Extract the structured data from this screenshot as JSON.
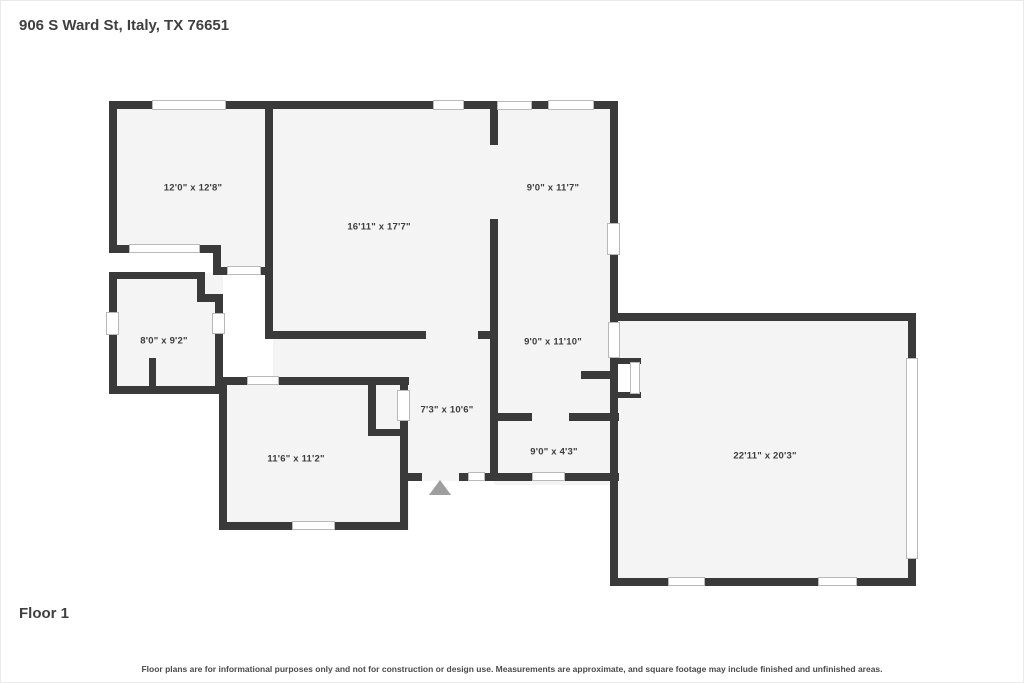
{
  "header": {
    "title": "906 S Ward St, Italy, TX 76651"
  },
  "floor_label": "Floor 1",
  "disclaimer": "Floor plans are for informational purposes only and not for construction or design use. Measurements are approximate, and square footage may include finished and unfinished areas.",
  "colors": {
    "wall": "#3a3a3a",
    "room_fill": "#f4f4f4",
    "window_border": "#b9b9b9",
    "door_marker": "#9e9e9e",
    "text": "#3d3d3d"
  },
  "rooms": [
    {
      "id": "room-top-left",
      "label": "12'0\" x 12'8\""
    },
    {
      "id": "room-center",
      "label": "16'11\" x 17'7\""
    },
    {
      "id": "room-top-right",
      "label": "9'0\" x 11'7\""
    },
    {
      "id": "room-mid-left",
      "label": "8'0\" x 9'2\""
    },
    {
      "id": "room-mid-right",
      "label": "9'0\" x 11'10\""
    },
    {
      "id": "hallway",
      "label": "7'3\" x 10'6\""
    },
    {
      "id": "room-small",
      "label": "9'0\" x 4'3\""
    },
    {
      "id": "room-bottom-left",
      "label": "11'6\" x 11'2\""
    },
    {
      "id": "room-garage",
      "label": "22'11\" x 20'3\""
    }
  ]
}
